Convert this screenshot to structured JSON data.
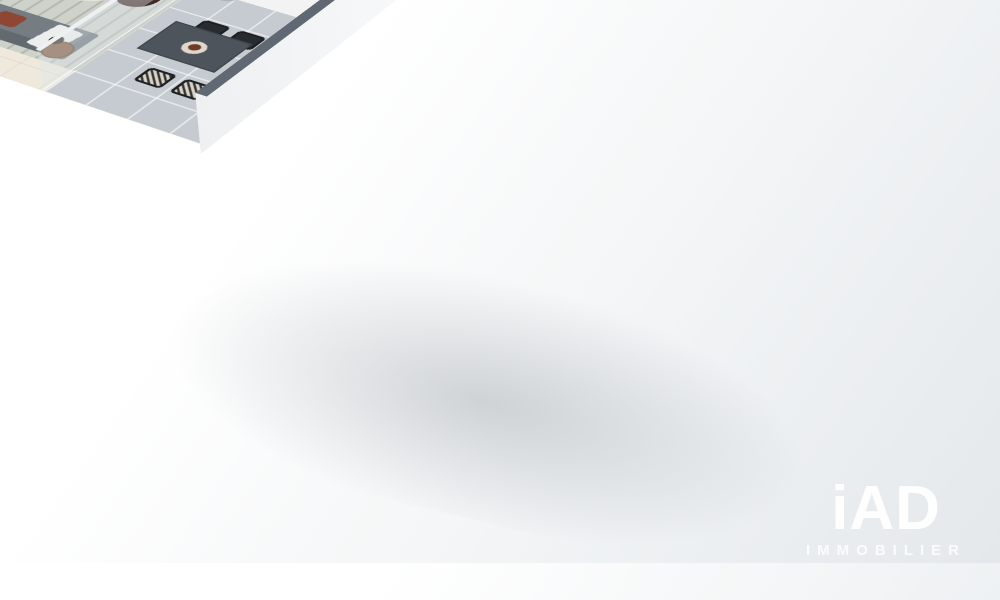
{
  "scene": {
    "type": "3d-isometric-floor-plan",
    "style": "cutaway apartment render on white background"
  },
  "wall_art": {
    "line1": "THINK",
    "line2": "LESS",
    "line3": "DO",
    "line4": "MORE"
  },
  "watermark": {
    "brand": "iAD",
    "tagline": "IMMOBILIER"
  },
  "palette": {
    "background": "#eef1f3",
    "wall_top_gray": "#5d6570",
    "wall_white": "#f7f8f8",
    "bathroom_tile": "#42474f",
    "wood_floor": "#c89c62",
    "cream_tile": "#efe9dd",
    "terrace_tile": "#c6cbd1",
    "accent_rust": "#ad4e38",
    "blanket_brown": "#7b4a33",
    "sofa_gray": "#757c82",
    "kitchen_wood": "#6b4830",
    "plant_green": "#4c7a3a"
  },
  "rooms": [
    {
      "name": "bedroom",
      "items": [
        "double bed",
        "nightstands",
        "mushroom lamps",
        "window with curtain",
        "patterned rug",
        "plant"
      ]
    },
    {
      "name": "bathroom",
      "items": [
        "walk-in shower",
        "washbasin",
        "towel radiator",
        "dark tiles"
      ]
    },
    {
      "name": "entry",
      "items": [
        "front door",
        "console table",
        "framed wall art"
      ]
    },
    {
      "name": "wc-laundry",
      "items": [
        "toilet",
        "shelf with towels"
      ]
    },
    {
      "name": "dressing",
      "items": [
        "open wardrobe",
        "hanging clothes"
      ]
    },
    {
      "name": "living-room",
      "items": [
        "gray sofa",
        "oval coffee table",
        "tv",
        "tv cabinet",
        "pouf",
        "side table with lamp",
        "rug"
      ]
    },
    {
      "name": "dining-area",
      "items": [
        "round wood table",
        "3 rust chairs",
        "3 round mirrors",
        "tall plant"
      ]
    },
    {
      "name": "kitchen",
      "items": [
        "white cabinets",
        "cooktop with pot",
        "oven",
        "stainless sink",
        "wood breakfast bar",
        "fruit"
      ]
    },
    {
      "name": "terrace",
      "items": [
        "outdoor dining table",
        "4 black chairs",
        "planters",
        "lantern",
        "glass railing"
      ]
    }
  ]
}
